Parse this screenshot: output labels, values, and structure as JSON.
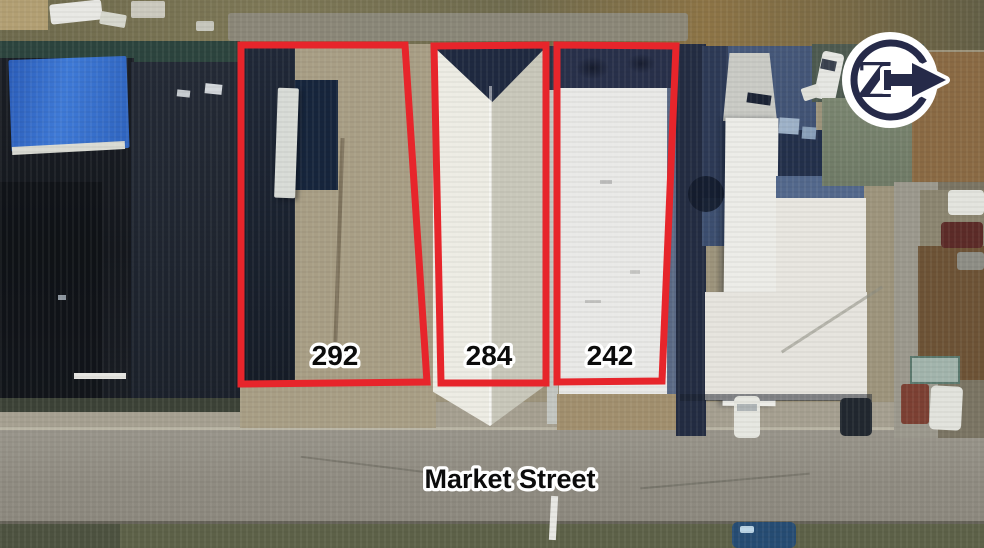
{
  "annotations": {
    "parcels": [
      {
        "label": "292"
      },
      {
        "label": "284"
      },
      {
        "label": "242"
      }
    ],
    "street_label": "Market Street",
    "compass_letter": "Z"
  },
  "colors": {
    "outline_red": "#e7252b",
    "compass_navy": "#262a49",
    "label_fill": "#0c0c0c",
    "label_stroke": "#ffffff"
  }
}
